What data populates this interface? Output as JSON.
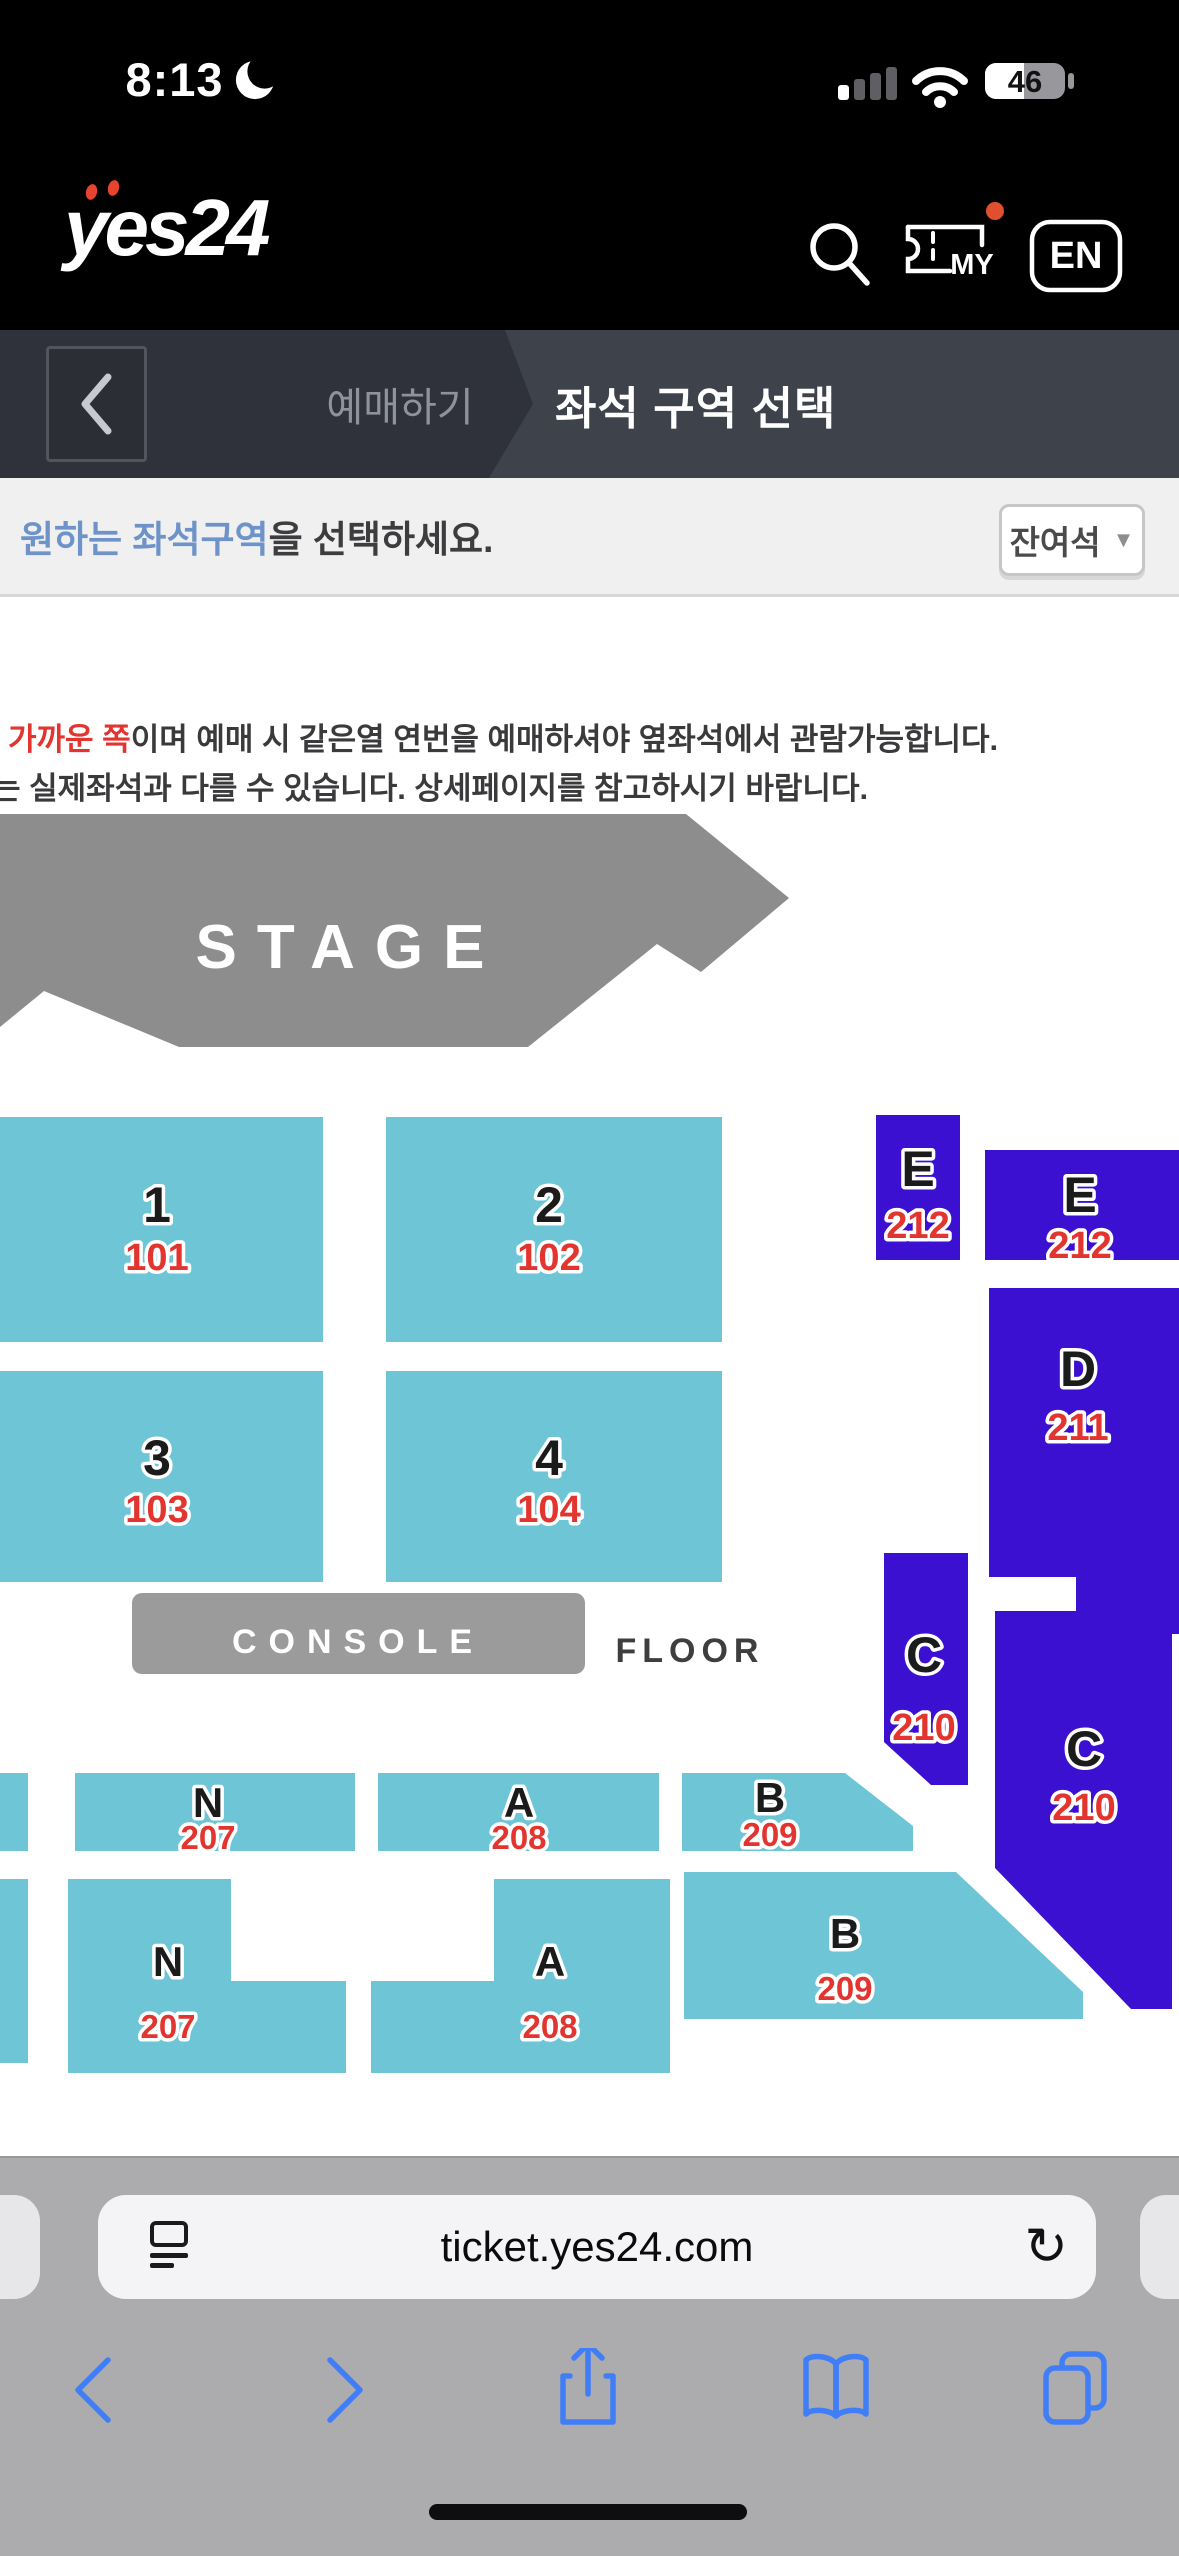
{
  "status": {
    "time": "8:13",
    "battery": "46"
  },
  "header": {
    "logo": "yes24",
    "my": "MY",
    "lang": "EN"
  },
  "nav": {
    "breadcrumb": "예매하기",
    "title": "좌석 구역 선택"
  },
  "sub": {
    "highlight": "원하는 좌석구역",
    "rest": "을 선택하세요.",
    "filter": "잔여석",
    "filter_arrow": "▼"
  },
  "notice": {
    "l1_red": "가까운 쪽",
    "l1": "이며 예매 시 같은열 연번을 예매하셔야 옆좌석에서 관람가능합니다.",
    "l2": "는 실제좌석과 다를 수 있습니다. 상세페이지를 참고하시기 바랍니다."
  },
  "map": {
    "stage": "STAGE",
    "console": "CONSOLE",
    "floor": "FLOOR"
  },
  "sections": [
    {
      "letter": "1",
      "number": "101"
    },
    {
      "letter": "2",
      "number": "102"
    },
    {
      "letter": "3",
      "number": "103"
    },
    {
      "letter": "4",
      "number": "104"
    },
    {
      "letter": "E",
      "number": "212"
    },
    {
      "letter": "E",
      "number": "212"
    },
    {
      "letter": "D",
      "number": "211"
    },
    {
      "letter": "C",
      "number": "210"
    },
    {
      "letter": "C",
      "number": "210"
    },
    {
      "letter": "N",
      "number": "207"
    },
    {
      "letter": "A",
      "number": "208"
    },
    {
      "letter": "B",
      "number": "209"
    },
    {
      "letter": "N",
      "number": "207"
    },
    {
      "letter": "A",
      "number": "208"
    },
    {
      "letter": "B",
      "number": "209"
    }
  ],
  "colors": {
    "floor_zone": "#6ec5d6",
    "tier_zone": "#3b10d0",
    "zone_number": "#e23530",
    "stage_gray": "#8d8d8d",
    "accent_blue": "#6e93c9",
    "safari_icon_blue": "#3f7ef6"
  },
  "browser": {
    "url": "ticket.yes24.com",
    "reload_icon": "↻"
  }
}
